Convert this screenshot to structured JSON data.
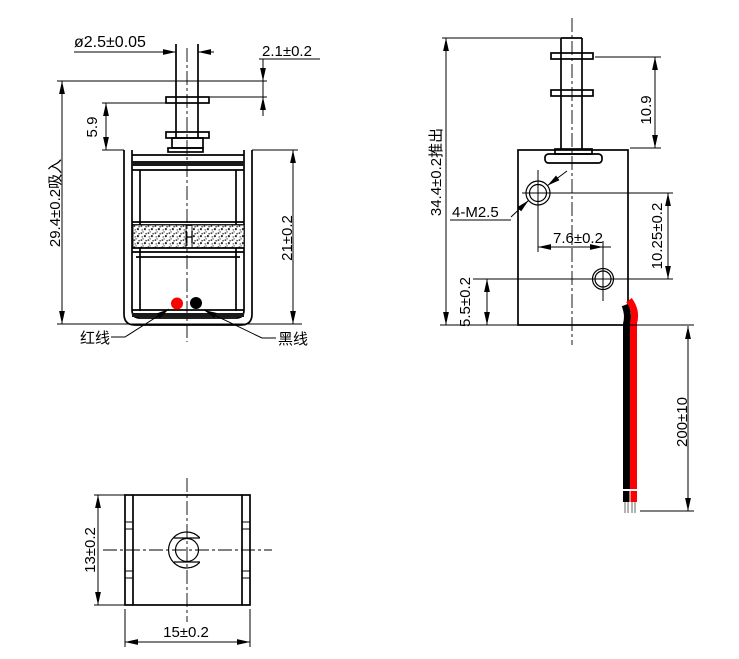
{
  "colors": {
    "red": "#ff0000",
    "black": "#000000",
    "line": "#000000"
  },
  "front_view": {
    "plunger_diameter": "ø2.5±0.05",
    "stroke_gap": "2.1±0.2",
    "flange_offset": "5.9",
    "retracted_height": "29.4±0.2吸入",
    "body_height": "21±0.2",
    "red_wire_label": "红线",
    "black_wire_label": "黑线"
  },
  "side_view": {
    "extended_height": "34.4±0.2推出",
    "plunger_extension": "10.9",
    "mounting_thread": "4-M2.5",
    "hole_spacing_horizontal": "7.6±0.2",
    "hole_spacing_vertical": "10.25±0.2",
    "hole_bottom_offset": "5.5±0.2",
    "lead_wire_length": "200±10"
  },
  "bottom_view": {
    "body_depth": "13±0.2",
    "body_width": "15±0.2"
  }
}
